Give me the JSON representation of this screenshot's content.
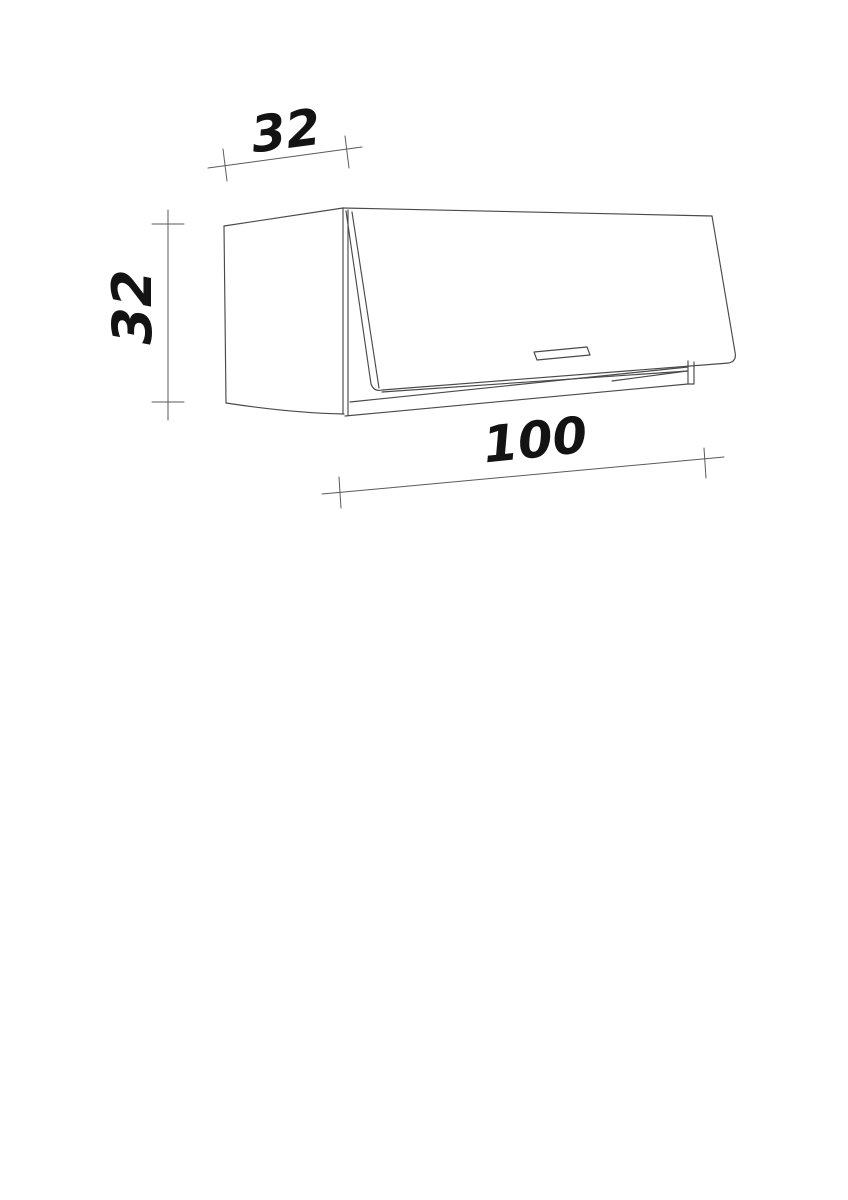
{
  "page": {
    "background": "#ffffff"
  },
  "drawing": {
    "subject": "wall-cabinet-with-flap-door",
    "dimensions": {
      "depth": {
        "value": "32"
      },
      "height": {
        "value": "32"
      },
      "width": {
        "value": "100"
      }
    },
    "colors": {
      "cabinet_line": "#4a4a4a",
      "dimension_line": "#5a5a5a",
      "label": "#131313"
    }
  }
}
